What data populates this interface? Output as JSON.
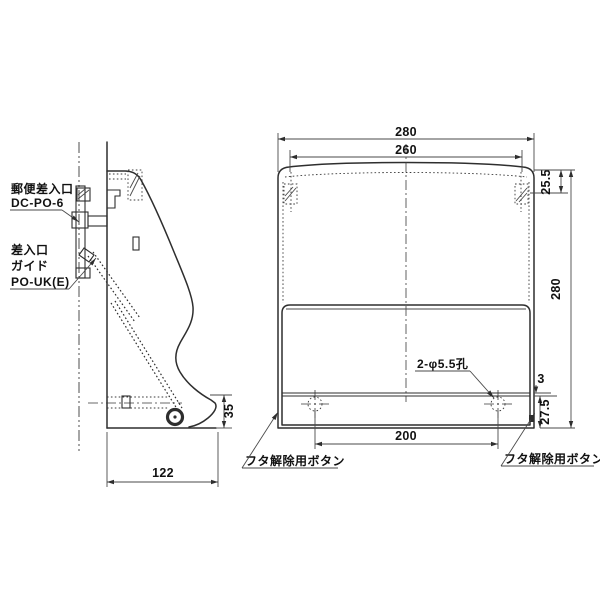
{
  "drawing": {
    "part_labels": {
      "mail_slot_name": "郵便差入口",
      "mail_slot_model": "DC-PO-6",
      "guide_line1": "差入口",
      "guide_line2": "ガイド",
      "guide_model": "PO-UK(E)",
      "lid_release_left": "フタ解除用ボタン",
      "lid_release_right": "フタ解除用ボタン",
      "hole_note": "2-φ5.5孔"
    },
    "dimensions": {
      "overall_width": "280",
      "inner_width": "260",
      "top_corner_height": "25.5",
      "overall_height": "280",
      "plate_offset": "3",
      "bottom_zone_height": "27.5",
      "hole_pitch": "200",
      "depth": "122",
      "foot_height": "35"
    },
    "colors": {
      "line": "#2e2e2e",
      "background": "#ffffff",
      "text": "#111111"
    }
  }
}
